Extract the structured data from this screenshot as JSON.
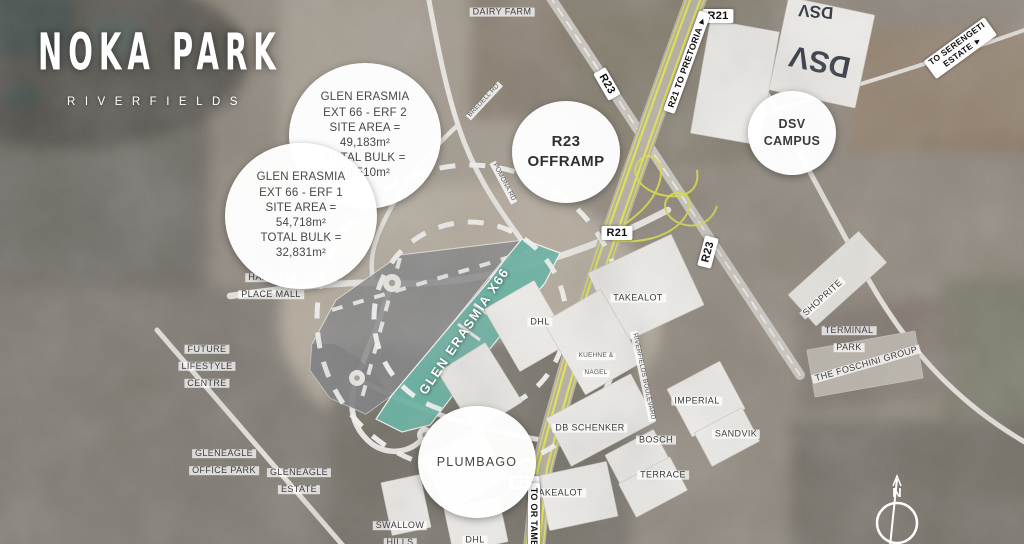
{
  "brand": {
    "title": "NOKA PARK",
    "subtitle": "RIVERFIELDS"
  },
  "callouts": {
    "erf2": {
      "lines": [
        "GLEN ERASMIA",
        "EXT 66 - ERF 2",
        "SITE AREA =",
        "49,183m²",
        "TOTAL BULK =",
        "29,510m²"
      ]
    },
    "erf1": {
      "lines": [
        "GLEN ERASMIA",
        "EXT 66 - ERF 1",
        "SITE AREA =",
        "54,718m²",
        "TOTAL BULK =",
        "32,831m²"
      ]
    },
    "r23_offramp": {
      "lines": [
        "R23",
        "OFFRAMP"
      ]
    },
    "dsv_campus": {
      "lines": [
        "DSV",
        "CAMPUS"
      ]
    },
    "plumbago": {
      "lines": [
        "PLUMBAGO"
      ]
    }
  },
  "site_label": "GLEN ERASMIA X66",
  "roads": {
    "r21_top": "R21",
    "r21_to_pretoria": "R21 TO PRETORIA ►",
    "r23_top": "R23",
    "r21_mid": "R21",
    "r23_mid": "R23",
    "r21_south": "R21",
    "to_or_tambo": "TO OR TAMBO",
    "serengeti": [
      "TO SERENGETI",
      "ESTATE ►"
    ]
  },
  "places": {
    "dairy_farm": "DAIRY FARM",
    "harvest": [
      "HARVEST",
      "PLACE MALL"
    ],
    "future_lifestyle": [
      "FUTURE",
      "LIFESTYLE",
      "CENTRE"
    ],
    "gleneagle_office": [
      "GLENEAGLE",
      "OFFICE PARK"
    ],
    "gleneagle_estate": [
      "GLENEAGLE",
      "ESTATE"
    ],
    "swallow_hills": [
      "SWALLOW",
      "HILLS"
    ],
    "dhl_north": "DHL",
    "kuehne_nagel": [
      "KUEHNE &",
      "NAGEL"
    ],
    "takealot_north": "TAKEALOT",
    "imperial": "IMPERIAL",
    "db_schenker": "DB SCHENKER",
    "bosch": "BOSCH",
    "sandvik": "SANDVIK",
    "terrace": "TERRACE",
    "takealot_south": "TAKEALOT",
    "dhl_south": "DHL",
    "shoprite": "SHOPRITE",
    "terminal_park": [
      "TERMINAL",
      "PARK"
    ],
    "foschini": "THE FOSCHINI GROUP",
    "riverfields_blvd": "RIVERFIELDS BOULEVARD",
    "bredell_rd": "BREDELL RD",
    "pomona_rd": "POMONA RD"
  },
  "dsv_building": "DSV",
  "compass": {
    "north": "N"
  },
  "colors": {
    "site_teal": "#5eb1a0",
    "erf_gray": "#7d7e80",
    "highway_yellow": "#e6ea3e",
    "label_bg": "#ffffff"
  }
}
